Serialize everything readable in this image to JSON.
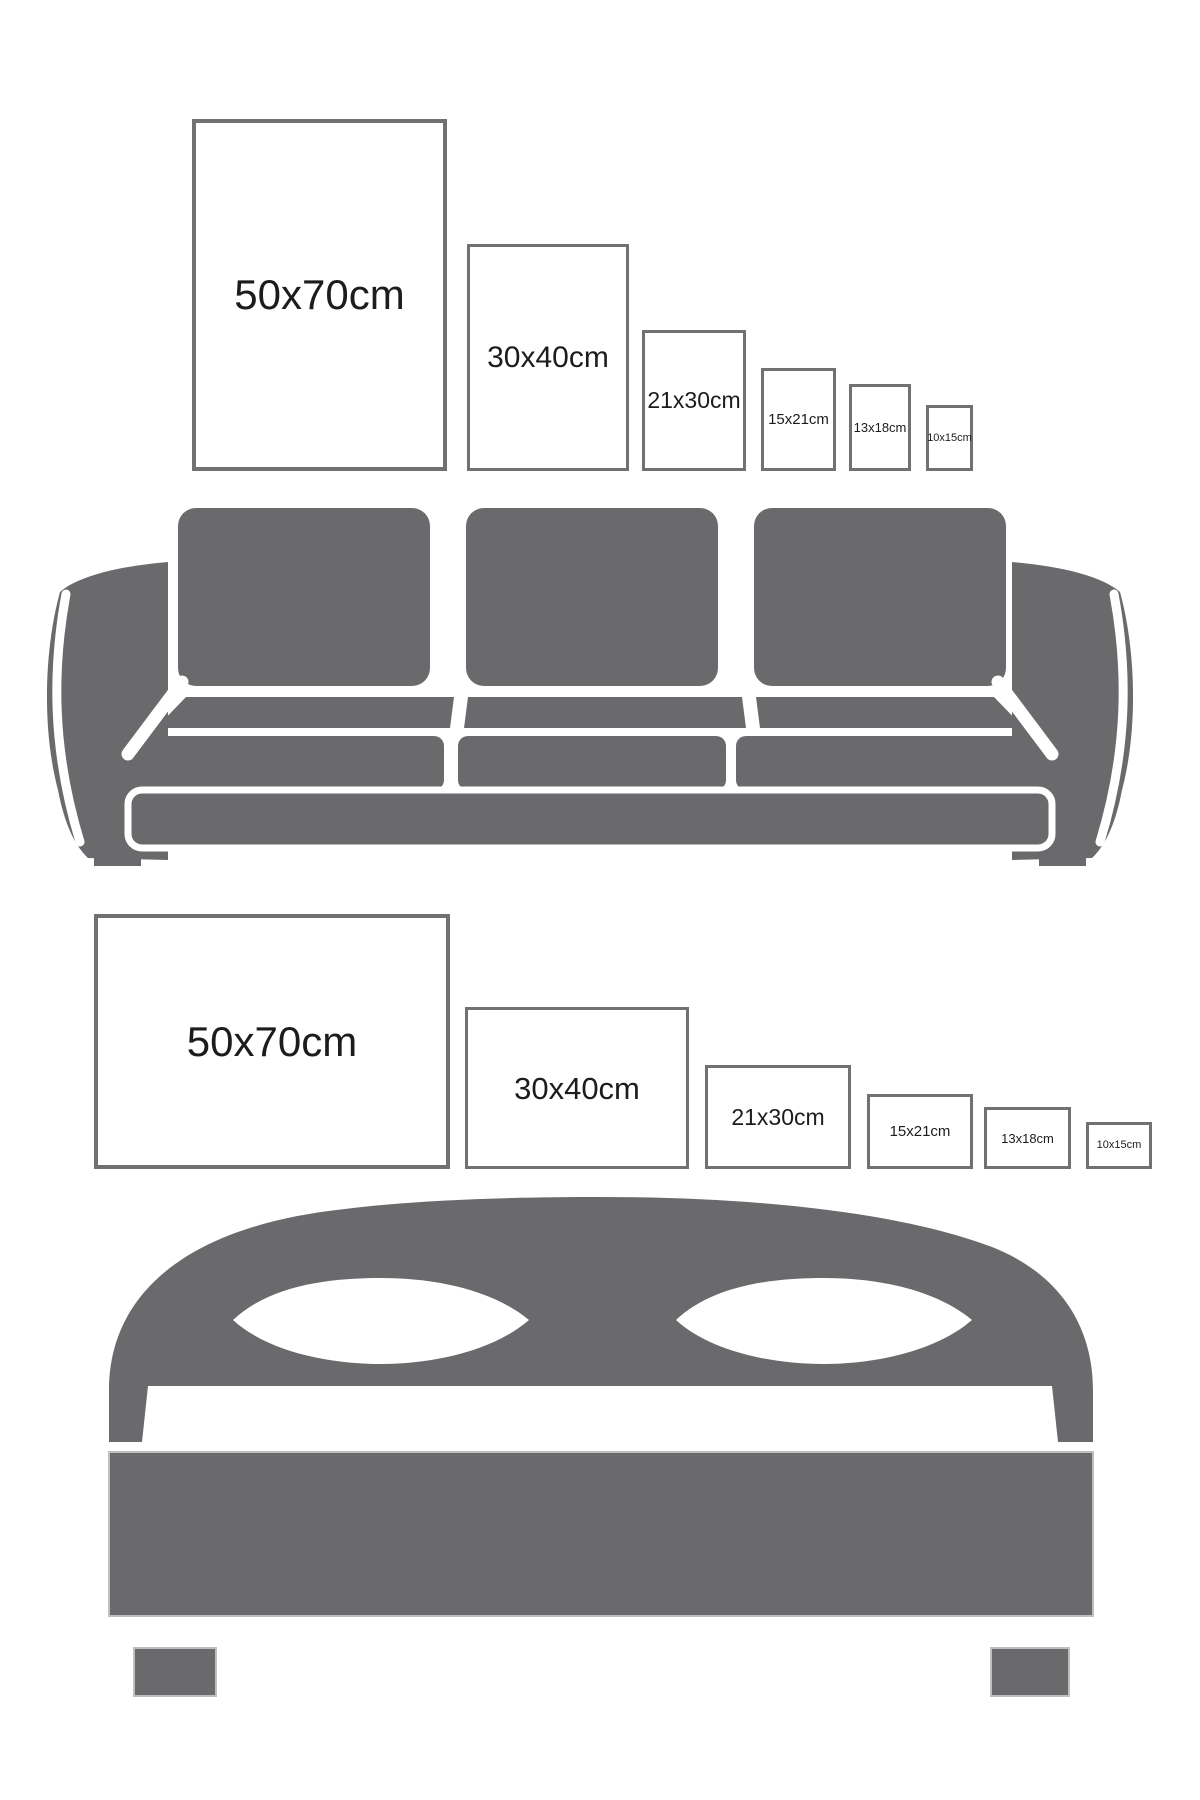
{
  "colors": {
    "background": "#ffffff",
    "furniture_gray": "#6a6a6d",
    "frame_border": "#6f7173",
    "label_text": "#1c1c1c",
    "outline_light": "#bfbfbf"
  },
  "sections": {
    "sofa": {
      "icon": "sofa-icon",
      "frame_orientation": "portrait",
      "frames": [
        {
          "label": "50x70cm"
        },
        {
          "label": "30x40cm"
        },
        {
          "label": "21x30cm"
        },
        {
          "label": "15x21cm"
        },
        {
          "label": "13x18cm"
        },
        {
          "label": "10x15cm"
        }
      ]
    },
    "bed": {
      "icon": "bed-icon",
      "frame_orientation": "landscape",
      "frames": [
        {
          "label": "50x70cm"
        },
        {
          "label": "30x40cm"
        },
        {
          "label": "21x30cm"
        },
        {
          "label": "15x21cm"
        },
        {
          "label": "13x18cm"
        },
        {
          "label": "10x15cm"
        }
      ]
    }
  }
}
